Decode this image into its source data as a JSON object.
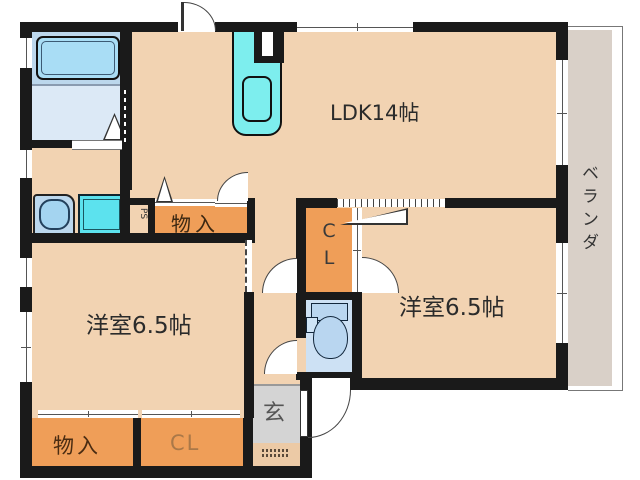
{
  "plan": {
    "title": "2LDK floor plan",
    "ldk_label": "LDK14帖",
    "bedroom_left_label": "洋室6.5帖",
    "bedroom_right_label": "洋室6.5帖",
    "hall_storage_label": "物入",
    "bedroom_storage_label": "物入",
    "bedroom_closet_label": "CL",
    "center_closet_line1": "C",
    "center_closet_line2": "L",
    "entrance_label": "玄",
    "veranda_label": "ベランダ",
    "pipe_space_label": "PS"
  },
  "fixtures": {
    "bathtub": "bathtub",
    "kitchen_sink": "kitchen-sink",
    "exhaust_duct": "duct",
    "washing_machine": "washing-machine",
    "washbasin": "washbasin",
    "toilet": "toilet"
  },
  "colors": {
    "wall": "#1a1a1a",
    "room_floor": "#f2d3b2",
    "closet_orange": "#ef9e58",
    "entrance_gray": "#d4d4d4",
    "veranda_gray": "#d9d0c8",
    "bath_upper": "#bcd7ec",
    "bath_lower": "#dce9f6",
    "bathtub_fill": "#a9ddf5",
    "kitchen_cyan": "#7deeee",
    "washer_cyan": "#5ce2ee",
    "toilet_floor": "#cde1f4",
    "fixture_blue": "#b9d6f0",
    "label_dark": "#2b2b2b",
    "label_brown": "#4a2c12",
    "label_light_brown": "#aa7848"
  }
}
